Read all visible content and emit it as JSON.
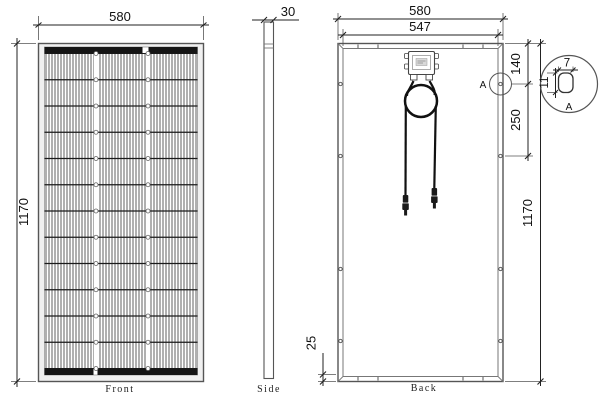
{
  "drawing": {
    "front": {
      "label": "Front",
      "width_dim": "580",
      "height_dim": "1170",
      "cell_rows": 12,
      "cell_columns": 3
    },
    "side": {
      "label": "Side",
      "thickness_dim": "30"
    },
    "back": {
      "label": "Back",
      "width_dim": "580",
      "inner_width_dim": "547",
      "height_dim": "1170",
      "hole_offset_top_dim": "140",
      "hole_spacing_dim": "250",
      "frame_depth_dim": "25",
      "section_marker": "A"
    },
    "detail_a": {
      "label": "A",
      "slot_width_dim": "7",
      "slot_height_dim": "11"
    },
    "colors": {
      "line": "#333333",
      "frame": "#555555",
      "busbar": "#151515",
      "cable": "#111111",
      "background": "#ffffff"
    }
  }
}
